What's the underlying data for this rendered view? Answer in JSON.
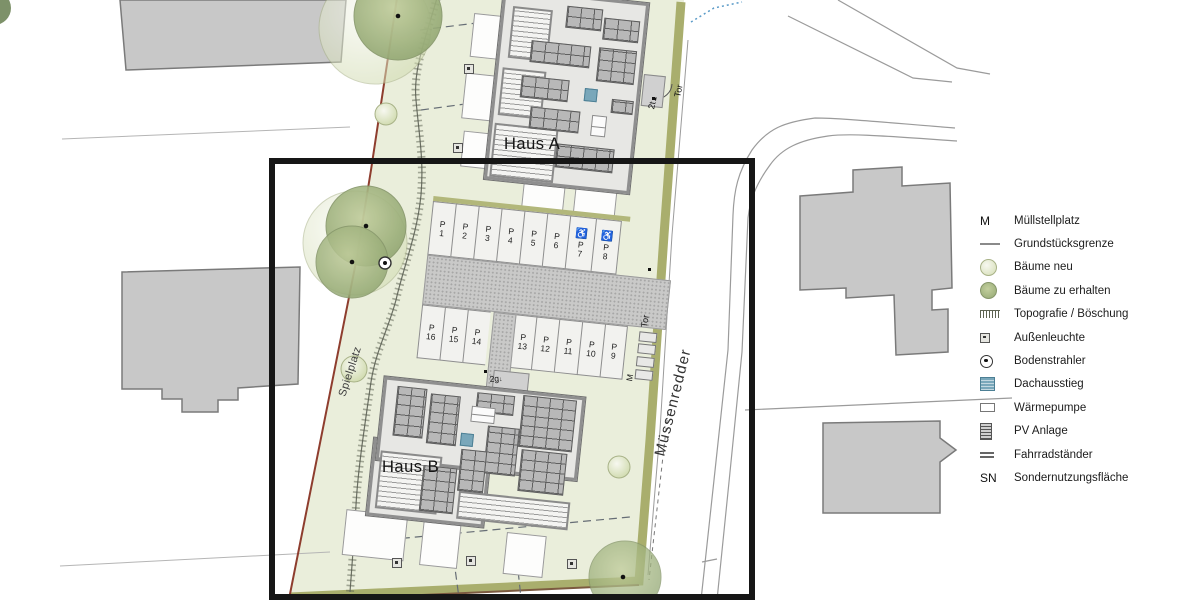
{
  "plan": {
    "haus_a_label": "Haus A",
    "haus_b_label": "Haus B",
    "street_name": "Müssenredder",
    "playground_label": "Spielplatz",
    "gate_label_top": "Tor",
    "gate_code_top": "2t",
    "gate_label_parking": "Tor",
    "entrance_code": "2g",
    "waste_label": "M",
    "up_arrow": "▲",
    "down_arrow": "↓"
  },
  "parking": {
    "prefix": "P",
    "top_row": [
      "1",
      "2",
      "3",
      "4",
      "5",
      "6",
      "7",
      "8"
    ],
    "top_accessible": [
      "7",
      "8"
    ],
    "bottom_row": [
      "16",
      "15",
      "14",
      "13",
      "12",
      "11",
      "10",
      "9"
    ],
    "wheelchair_icon": "♿"
  },
  "legend": {
    "items": [
      {
        "type": "text",
        "symbol": "M",
        "label": "Müllstellplatz"
      },
      {
        "type": "line",
        "symbol": "",
        "label": "Grundstücksgrenze"
      },
      {
        "type": "tree-new",
        "symbol": "",
        "label": "Bäume neu"
      },
      {
        "type": "tree-keep",
        "symbol": "",
        "label": "Bäume zu erhalten"
      },
      {
        "type": "topo",
        "symbol": "",
        "label": "Topografie / Böschung"
      },
      {
        "type": "lamp",
        "symbol": "",
        "label": "Außenleuchte"
      },
      {
        "type": "spot",
        "symbol": "",
        "label": "Bodenstrahler"
      },
      {
        "type": "roof",
        "symbol": "",
        "label": "Dachausstieg"
      },
      {
        "type": "hp",
        "symbol": "",
        "label": "Wärmepumpe"
      },
      {
        "type": "pv",
        "symbol": "",
        "label": "PV Anlage"
      },
      {
        "type": "bike",
        "symbol": "",
        "label": "Fahrradständer"
      },
      {
        "type": "text",
        "symbol": "SN",
        "label": "Sondernutzungsfläche"
      }
    ]
  },
  "colors": {
    "site-green": "#eaeedb",
    "hedge-olive": "#a9ae6d",
    "boundary-red": "#8e3d2e",
    "building-gray": "#c8c8c8",
    "haus-fill": "#e7e7e4",
    "pv-panel": "#b8b8b8",
    "roof-blue": "#79a7ba",
    "paving": "#c9c9c8",
    "frame-black": "#161616"
  }
}
